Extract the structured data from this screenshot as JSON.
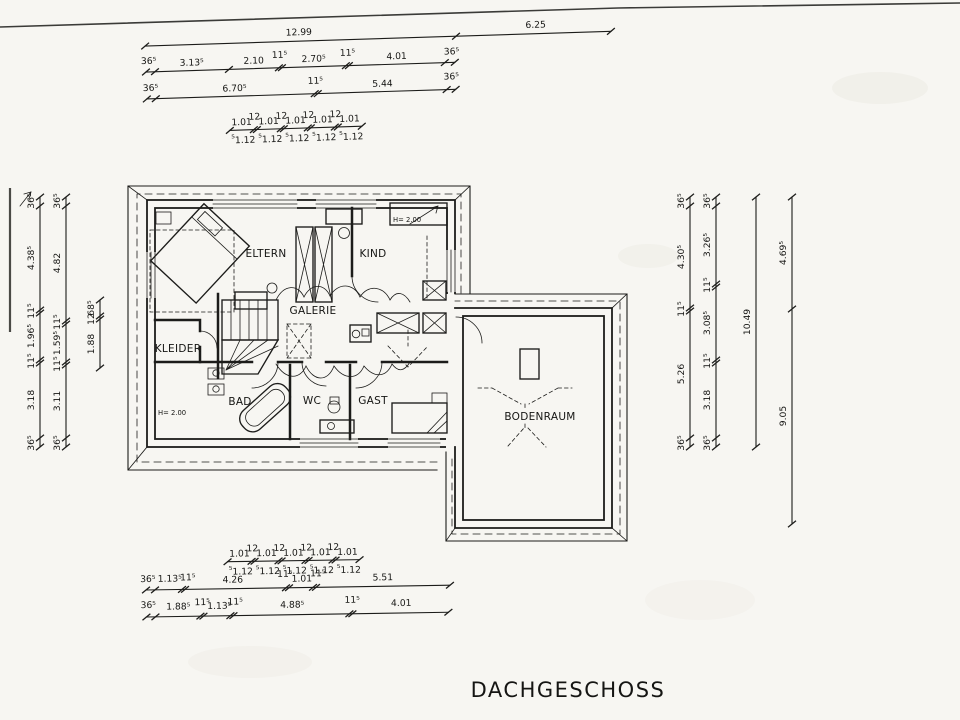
{
  "title": "DACHGESCHOSS",
  "colors": {
    "paper": "#f7f6f2",
    "ink": "#1c1c1a"
  },
  "rooms": {
    "eltern": "ELTERN",
    "kind": "KIND",
    "galerie": "GALERIE",
    "kleider": "KLEIDER",
    "bad": "BAD",
    "wc": "WC",
    "gast": "GAST",
    "bodenraum": "BODENRAUM"
  },
  "annotations": {
    "height_kind": "H= 2.00",
    "height_kleider": "H= 2.00"
  },
  "dims": {
    "top_overall": [
      "12.99",
      "6.25"
    ],
    "top_chain_a": [
      "36⁵",
      "3.13⁵",
      "2.10",
      "11⁵",
      "2.70⁵",
      "11⁵",
      "4.01",
      "36⁵"
    ],
    "top_chain_b": [
      "36⁵",
      "6.70⁵",
      "11⁵",
      "5.44",
      "36⁵"
    ],
    "grid_upper": [
      "1.01",
      "12",
      "1.01",
      "12",
      "1.01",
      "12",
      "1.01",
      "12",
      "1.01"
    ],
    "grid_lower": [
      "⁵",
      "1.12",
      "⁵",
      "1.12",
      "⁵",
      "1.12",
      "⁵",
      "1.12",
      "⁵",
      "1.12"
    ],
    "left_chain_a": [
      "36⁵",
      "4.38⁵",
      "11⁵",
      "1.96⁵",
      "11⁵",
      "3.18",
      "36⁵"
    ],
    "left_chain_b": [
      "36⁵",
      "4.82",
      "11⁵",
      "1.59⁵",
      "11⁵",
      "3.11",
      "36⁵"
    ],
    "left_chain_c": [
      "68⁵",
      "12",
      "1.88"
    ],
    "right_chain_a": [
      "36⁵",
      "4.30⁵",
      "11⁵",
      "5.26",
      "36⁵"
    ],
    "right_chain_b": [
      "36⁵",
      "3.26⁵",
      "11⁵",
      "3.08⁵",
      "11⁵",
      "3.18",
      "36⁵"
    ],
    "right_overall": "10.49",
    "right_wing": [
      "4.69⁵",
      "9.05"
    ],
    "bottom_chain_a": [
      "36⁵",
      "1.13⁵",
      "11⁵",
      "4.26",
      "11⁵",
      "1.01",
      "11⁵",
      "5.51"
    ],
    "bottom_chain_b": [
      "36⁵",
      "1.88⁵",
      "11⁵",
      "1.13⁵",
      "11⁵",
      "4.88⁵",
      "11⁵",
      "4.01"
    ]
  }
}
